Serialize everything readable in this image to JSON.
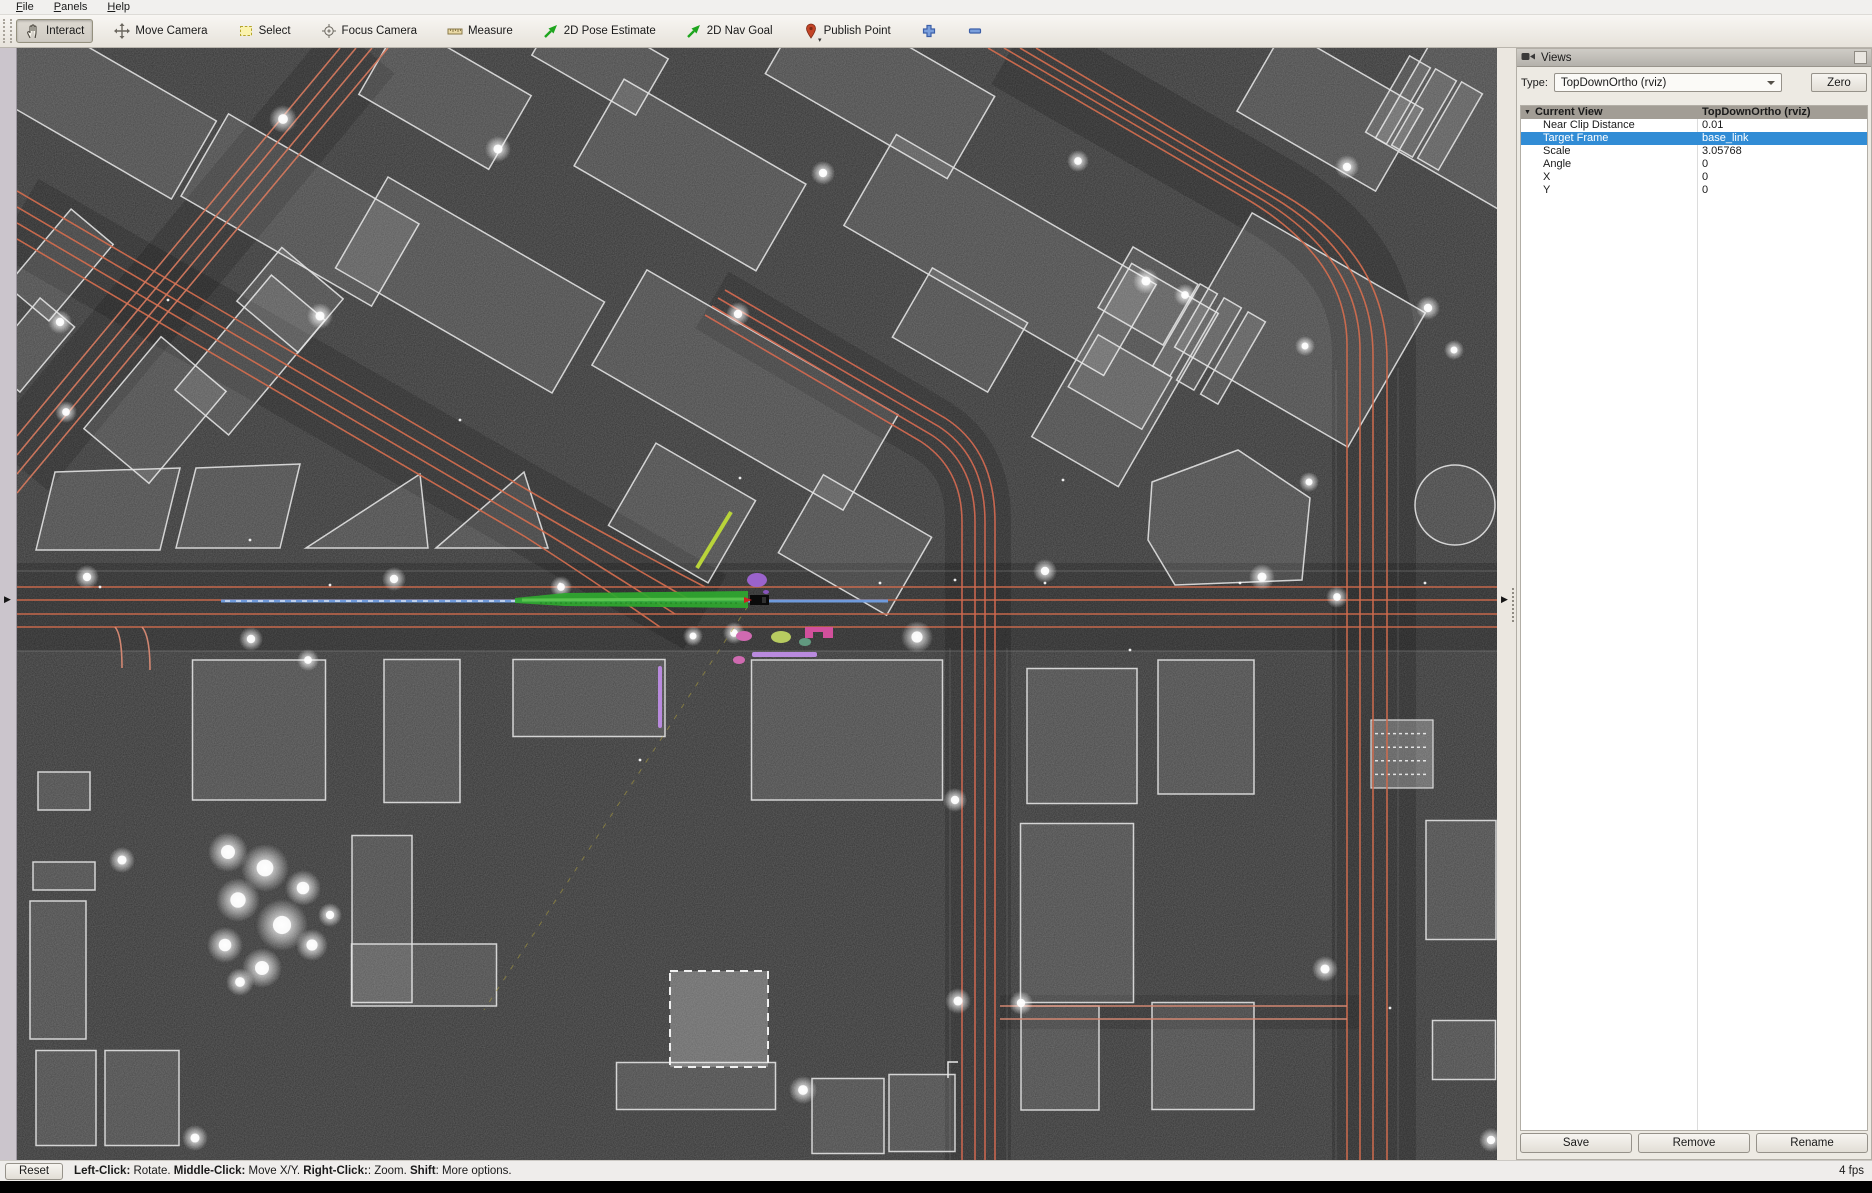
{
  "menu": {
    "items": [
      {
        "accel": "F",
        "rest": "ile"
      },
      {
        "accel": "P",
        "rest": "anels"
      },
      {
        "accel": "H",
        "rest": "elp"
      }
    ]
  },
  "toolbar": {
    "buttons": [
      {
        "icon": "hand-icon",
        "label": "Interact",
        "active": true
      },
      {
        "icon": "move-camera-icon",
        "label": "Move Camera",
        "active": false
      },
      {
        "icon": "select-icon",
        "label": "Select",
        "active": false
      },
      {
        "icon": "focus-camera-icon",
        "label": "Focus Camera",
        "active": false
      },
      {
        "icon": "measure-icon",
        "label": "Measure",
        "active": false
      },
      {
        "icon": "pose-estimate-icon",
        "label": "2D Pose Estimate",
        "active": false
      },
      {
        "icon": "nav-goal-icon",
        "label": "2D Nav Goal",
        "active": false
      },
      {
        "icon": "publish-point-icon",
        "label": "Publish Point",
        "active": false
      },
      {
        "icon": "plus-icon",
        "label": "",
        "active": false
      },
      {
        "icon": "minus-icon",
        "label": "",
        "active": false
      }
    ],
    "overflow_caret": "▾"
  },
  "views_panel": {
    "title": "Views",
    "type_label": "Type:",
    "type_value": "TopDownOrtho (rviz)",
    "zero_label": "Zero",
    "tree": {
      "header": {
        "label": "Current View",
        "value": "TopDownOrtho (rviz)"
      },
      "rows": [
        {
          "label": "Near Clip Distance",
          "value": "0.01",
          "selected": false
        },
        {
          "label": "Target Frame",
          "value": "base_link",
          "selected": true
        },
        {
          "label": "Scale",
          "value": "3.05768",
          "selected": false
        },
        {
          "label": "Angle",
          "value": "0",
          "selected": false
        },
        {
          "label": "X",
          "value": "0",
          "selected": false
        },
        {
          "label": "Y",
          "value": "0",
          "selected": false
        }
      ]
    },
    "buttons": [
      "Save",
      "Remove",
      "Rename"
    ],
    "colors": {
      "selection": "#318cd5",
      "tree_header_bg": "#a29d95"
    }
  },
  "status_bar": {
    "reset_label": "Reset",
    "segments": [
      {
        "text": "Left-Click:",
        "bold": true
      },
      {
        "text": " Rotate.  ",
        "bold": false
      },
      {
        "text": "Middle-Click:",
        "bold": true
      },
      {
        "text": " Move X/Y.  ",
        "bold": false
      },
      {
        "text": "Right-Click:",
        "bold": true
      },
      {
        "text": ":  Zoom.  ",
        "bold": false
      },
      {
        "text": "Shift",
        "bold": true
      },
      {
        "text": ": More options.",
        "bold": false
      }
    ],
    "fps": "4 fps"
  },
  "viewport": {
    "colors": {
      "background": "#343434",
      "building_stroke": "#e2e2e2",
      "lane": "#cf6b4e",
      "lane_alt": "#d2785e",
      "curb": "#909090",
      "path_blue": "#6f9bdc",
      "trajectory_green": "#2fa82f",
      "marker_purple": "#b98ade",
      "marker_magenta": "#d2509c",
      "marker_pink": "#cf6ab0",
      "marker_lime": "#b7cb60",
      "marker_teal": "#61997f",
      "lime_edge": "#b9d43a"
    },
    "map": {
      "road_bands": [
        {
          "d": "M17,607 H1497",
          "w": 88,
          "op": 0.17
        },
        {
          "d": "M17,216 L705,612",
          "w": 86,
          "op": 0.15
        },
        {
          "d": "M364,48 L17,465",
          "w": 80,
          "op": 0.15
        },
        {
          "d": "M1012,48 L1270,196 Q1374,256 1374,352 V1160",
          "w": 84,
          "op": 0.16
        },
        {
          "d": "M978,1160 V520 Q978,458 932,430 L712,300",
          "w": 66,
          "op": 0.15
        },
        {
          "d": "M1000,1012 H1360",
          "w": 34,
          "op": 0.1
        }
      ],
      "curbs": [
        {
          "d": "M17,571 H1497",
          "op": 0.45
        },
        {
          "d": "M17,651 H1497",
          "op": 0.45
        },
        {
          "d": "M950,648 V1160",
          "op": 0.3
        },
        {
          "d": "M1007,648 V1160",
          "op": 0.3
        },
        {
          "d": "M1336,370 V1160",
          "op": 0.3
        },
        {
          "d": "M1398,368 V1160",
          "op": 0.3
        }
      ],
      "lane_groups": [
        {
          "color": "#ce6a4c",
          "paths": [
            "M17,587 H1497",
            "M17,600 H1497",
            "M17,614 H1497",
            "M17,627 H1497"
          ]
        },
        {
          "color": "#cf6b4e",
          "paths": [
            "M17,191 L560,509 Q630,548 705,587",
            "M17,207 L548,518 Q615,557 690,600",
            "M17,223 L536,527 Q600,566 675,614",
            "M17,239 L524,536 Q585,575 660,627"
          ]
        },
        {
          "color": "#d2785e",
          "paths": [
            "M340,48 L17,436",
            "M356,48 L17,455",
            "M372,48 L17,474",
            "M388,48 L17,493"
          ]
        },
        {
          "color": "#cf6b4e",
          "paths": [
            "M988,48 L1245,198 Q1347,258 1347,345 V1160",
            "M1004,48 L1258,197 Q1360,257 1360,350 V1160",
            "M1020,48 L1271,196 Q1373,256 1373,355 V1160",
            "M1036,48 L1284,195 Q1387,255 1387,360 V1160"
          ]
        },
        {
          "color": "#d06850",
          "paths": [
            "M962,1160 V522 Q962,468 920,441 L705,315",
            "M975,1160 V522 Q975,462 930,434 L712,306",
            "M985,1160 V522 Q985,456 938,426 L718,298",
            "M995,1160 V522 Q995,450 945,418 L725,290"
          ]
        },
        {
          "color": "#d98a74",
          "paths": [
            "M1000,1006 H1347",
            "M1000,1019 H1347",
            "M115,627 Q122,635 122,668",
            "M142,627 Q150,636 150,670"
          ]
        }
      ],
      "buildings_rot": [
        [
          90,
          100,
          240,
          90,
          30
        ],
        [
          300,
          210,
          220,
          95,
          30
        ],
        [
          445,
          95,
          150,
          85,
          30
        ],
        [
          600,
          57,
          120,
          65,
          30
        ],
        [
          470,
          285,
          250,
          105,
          30
        ],
        [
          690,
          175,
          210,
          100,
          30
        ],
        [
          880,
          85,
          210,
          95,
          30
        ],
        [
          745,
          390,
          290,
          110,
          30
        ],
        [
          1000,
          255,
          300,
          105,
          30
        ],
        [
          1125,
          375,
          100,
          200,
          30
        ],
        [
          1330,
          110,
          160,
          95,
          30
        ],
        [
          1510,
          135,
          230,
          140,
          30
        ],
        [
          1398,
          100,
          24,
          88,
          30
        ],
        [
          1424,
          113,
          24,
          88,
          30
        ],
        [
          1450,
          126,
          24,
          88,
          30
        ],
        [
          1300,
          330,
          200,
          155,
          30
        ],
        [
          1185,
          330,
          20,
          95,
          30
        ],
        [
          1209,
          344,
          20,
          95,
          30
        ],
        [
          1233,
          358,
          20,
          95,
          30
        ],
        [
          1148,
          296,
          75,
          70,
          30
        ],
        [
          1120,
          382,
          85,
          60,
          30
        ],
        [
          960,
          330,
          110,
          80,
          30
        ],
        [
          682,
          513,
          115,
          95,
          30
        ],
        [
          855,
          545,
          125,
          90,
          30
        ],
        [
          60,
          265,
          100,
          55,
          -50
        ],
        [
          30,
          345,
          85,
          45,
          -50
        ],
        [
          155,
          410,
          120,
          85,
          -50
        ],
        [
          250,
          355,
          150,
          70,
          -50
        ],
        [
          290,
          300,
          70,
          80,
          -50
        ],
        [
          259,
          730,
          133,
          140,
          0
        ],
        [
          422,
          731,
          76,
          143,
          0
        ],
        [
          589,
          698,
          152,
          77,
          0
        ],
        [
          847,
          730,
          191,
          140,
          0
        ],
        [
          64,
          791,
          52,
          38,
          0
        ],
        [
          64,
          876,
          62,
          28,
          0
        ],
        [
          58,
          970,
          56,
          138,
          0
        ],
        [
          66,
          1098,
          60,
          95,
          0
        ],
        [
          142,
          1098,
          74,
          95,
          0
        ],
        [
          382,
          919,
          60,
          167,
          0
        ],
        [
          424,
          975,
          145,
          62,
          0
        ],
        [
          696,
          1086,
          159,
          47,
          0
        ],
        [
          848,
          1116,
          72,
          75,
          0
        ],
        [
          922,
          1113,
          66,
          77,
          0
        ],
        [
          1082,
          736,
          110,
          135,
          0
        ],
        [
          1206,
          727,
          96,
          134,
          0
        ],
        [
          1077,
          913,
          113,
          179,
          0
        ],
        [
          1203,
          1056,
          102,
          107,
          0
        ],
        [
          1060,
          1058,
          78,
          104,
          0
        ],
        [
          1461,
          880,
          70,
          119,
          0
        ],
        [
          1464,
          1050,
          63,
          59,
          0
        ]
      ],
      "buildings_poly": [
        "55,472 180,468 160,550 36,550",
        "196,468 300,464 280,548 176,548",
        "306,548 420,474 428,548",
        "436,548 524,472 548,548",
        "1152,482 1238,450 1310,498 1302,580 1175,585 1148,540"
      ],
      "building_circle": [
        1455,
        505,
        40
      ],
      "building_dashed": {
        "x": 670,
        "y": 971,
        "w": 98,
        "h": 96
      },
      "building_dotted": {
        "x": 1371,
        "y": 720,
        "w": 62,
        "h": 68
      },
      "trees": [
        [
          283,
          119,
          14
        ],
        [
          498,
          149,
          13
        ],
        [
          823,
          173,
          12
        ],
        [
          1078,
          161,
          11
        ],
        [
          1347,
          167,
          12
        ],
        [
          320,
          316,
          13
        ],
        [
          738,
          314,
          12
        ],
        [
          60,
          322,
          12
        ],
        [
          1146,
          281,
          13
        ],
        [
          1185,
          295,
          11
        ],
        [
          1428,
          308,
          12
        ],
        [
          1305,
          346,
          10
        ],
        [
          66,
          412,
          11
        ],
        [
          87,
          577,
          12
        ],
        [
          394,
          579,
          12
        ],
        [
          561,
          587,
          11
        ],
        [
          734,
          633,
          11
        ],
        [
          693,
          636,
          10
        ],
        [
          917,
          637,
          16
        ],
        [
          251,
          639,
          12
        ],
        [
          308,
          660,
          11
        ],
        [
          1045,
          571,
          12
        ],
        [
          1262,
          577,
          13
        ],
        [
          1337,
          597,
          11
        ],
        [
          1454,
          350,
          10
        ],
        [
          1309,
          482,
          10
        ],
        [
          122,
          860,
          13
        ],
        [
          955,
          800,
          12
        ],
        [
          958,
          1001,
          13
        ],
        [
          1021,
          1003,
          12
        ],
        [
          1325,
          969,
          13
        ],
        [
          803,
          1090,
          14
        ],
        [
          195,
          1138,
          13
        ],
        [
          1491,
          1140,
          12
        ],
        [
          228,
          852,
          20
        ],
        [
          265,
          868,
          24
        ],
        [
          303,
          888,
          18
        ],
        [
          238,
          900,
          22
        ],
        [
          282,
          925,
          26
        ],
        [
          225,
          945,
          18
        ],
        [
          312,
          945,
          16
        ],
        [
          262,
          968,
          20
        ],
        [
          240,
          982,
          14
        ],
        [
          330,
          915,
          12
        ]
      ],
      "dots": [
        [
          100,
          587
        ],
        [
          330,
          585
        ],
        [
          560,
          584
        ],
        [
          880,
          583
        ],
        [
          1045,
          583
        ],
        [
          1240,
          583
        ],
        [
          955,
          580
        ],
        [
          1130,
          650
        ],
        [
          168,
          300
        ],
        [
          460,
          420
        ],
        [
          740,
          478
        ],
        [
          640,
          760
        ],
        [
          1390,
          1008
        ],
        [
          1063,
          480
        ],
        [
          250,
          540
        ],
        [
          1425,
          583
        ]
      ],
      "markers": [
        {
          "t": "line",
          "name": "dashed-boundary-yellow",
          "x1": 748,
          "y1": 606,
          "x2": 484,
          "y2": 1010,
          "stroke": "#a89a3e",
          "w": 1,
          "dash": "5,8",
          "op": 0.6
        },
        {
          "t": "line",
          "name": "planned-path-blue",
          "x1": 221,
          "y1": 601,
          "x2": 888,
          "y2": 601,
          "stroke": "#6f9bdc",
          "w": 3
        },
        {
          "t": "line",
          "name": "path-waypoint-dashes",
          "x1": 225,
          "y1": 601,
          "x2": 690,
          "y2": 601,
          "stroke": "#ffffff",
          "w": 1.2,
          "dash": "5,6",
          "op": 0.85
        },
        {
          "t": "poly",
          "name": "trajectory-cloud-green",
          "pts": "515,598 565,593 748,591 748,608 565,606 515,603",
          "fill": "#2fa82f",
          "op": 0.92
        },
        {
          "t": "line",
          "name": "trajectory-core",
          "x1": 522,
          "y1": 600,
          "x2": 745,
          "y2": 599,
          "stroke": "#63cc55",
          "w": 3,
          "op": 0.8
        },
        {
          "t": "line",
          "name": "trajectory-speckle",
          "x1": 540,
          "y1": 603,
          "x2": 740,
          "y2": 603,
          "stroke": "#1d7a1d",
          "w": 1,
          "dash": "2,3",
          "op": 0.9
        },
        {
          "t": "ellipse",
          "name": "detection-purple",
          "cx": 757,
          "cy": 580,
          "rx": 10,
          "ry": 7,
          "fill": "#9a63cc"
        },
        {
          "t": "ellipse",
          "name": "detection-pink-1",
          "cx": 744,
          "cy": 636,
          "rx": 8,
          "ry": 5,
          "fill": "#cf6ab0"
        },
        {
          "t": "ellipse",
          "name": "detection-lime",
          "cx": 781,
          "cy": 637,
          "rx": 10,
          "ry": 6,
          "fill": "#b7cb60"
        },
        {
          "t": "ellipse",
          "name": "detection-teal",
          "cx": 805,
          "cy": 642,
          "rx": 6,
          "ry": 4,
          "fill": "#61997f"
        },
        {
          "t": "ellipse",
          "name": "detection-pink-2",
          "cx": 739,
          "cy": 660,
          "rx": 6,
          "ry": 4,
          "fill": "#cf6ab0"
        },
        {
          "t": "path",
          "name": "detection-magenta",
          "d": "M805,638 V627 H833 V638 H823 V632 H813 V638 Z",
          "fill": "#d2509c"
        },
        {
          "t": "rect",
          "name": "lane-marker-purple-h",
          "x": 752,
          "y": 652,
          "wd": 65,
          "ht": 5,
          "rx": 2,
          "fill": "#b98ade"
        },
        {
          "t": "rect",
          "name": "lane-marker-purple-v",
          "x": 658,
          "y": 666,
          "wd": 4,
          "ht": 62,
          "rx": 2,
          "fill": "#b98ade"
        },
        {
          "t": "line",
          "name": "lime-building-edge",
          "x1": 697,
          "y1": 568,
          "x2": 731,
          "y2": 512,
          "stroke": "#b9d43a",
          "w": 4
        },
        {
          "t": "path",
          "name": "corner-bracket",
          "d": "M948,1078 V1062 H958",
          "stroke": "#e8e8e8",
          "w": 1.5,
          "fill": "none"
        },
        {
          "t": "rect",
          "name": "ego-vehicle",
          "x": 750,
          "y": 595,
          "wd": 19,
          "ht": 10,
          "fill": "#0a0a0a"
        },
        {
          "t": "poly",
          "name": "ego-heading",
          "pts": "744,597 752,600 744,603",
          "fill": "#cc2222"
        },
        {
          "t": "rect",
          "name": "ego-detail",
          "x": 762,
          "y": 597,
          "wd": 4,
          "ht": 6,
          "fill": "#303030"
        },
        {
          "t": "ellipse",
          "name": "ego-dot-purple",
          "cx": 766,
          "cy": 592,
          "rx": 3,
          "ry": 2,
          "fill": "#8855bb"
        }
      ]
    }
  }
}
